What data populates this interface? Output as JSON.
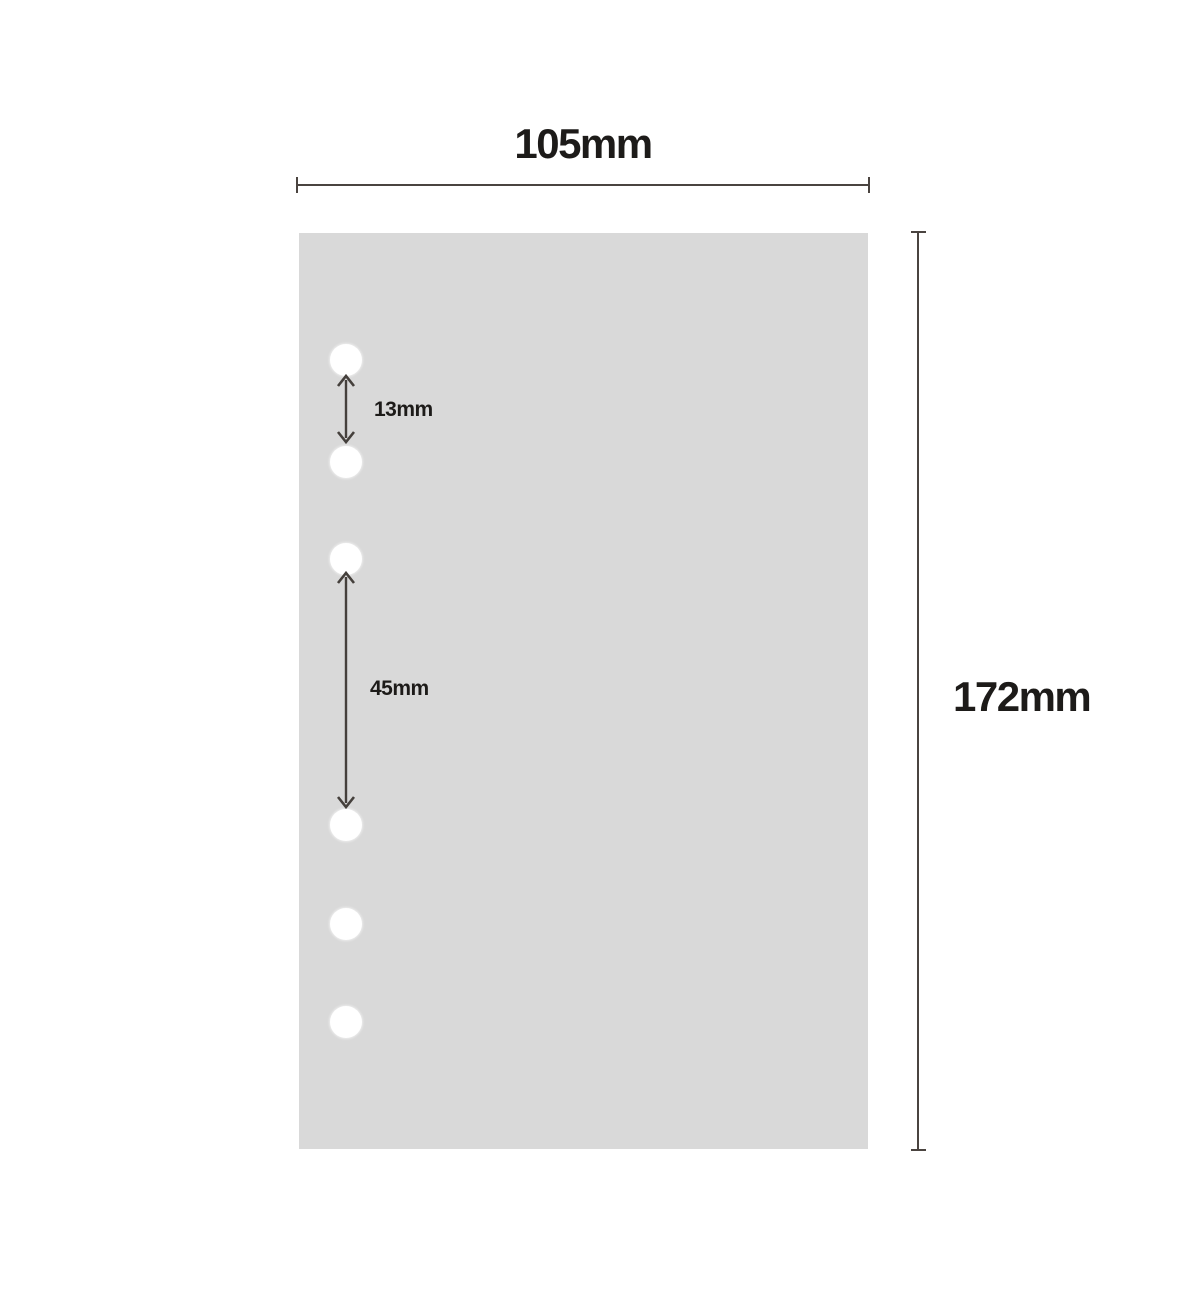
{
  "diagram": {
    "labels": {
      "sheet_width": "105mm",
      "sheet_height": "172mm",
      "hole_gap_small": "13mm",
      "hole_gap_large": "45mm"
    },
    "sheet": {
      "hole_count": 6,
      "fill_color": "#d9d9d9",
      "hole_color": "#ffffff"
    },
    "colors": {
      "background": "#ffffff",
      "dimension_line": "#4a4440",
      "label_text": "#1d1b19"
    }
  }
}
